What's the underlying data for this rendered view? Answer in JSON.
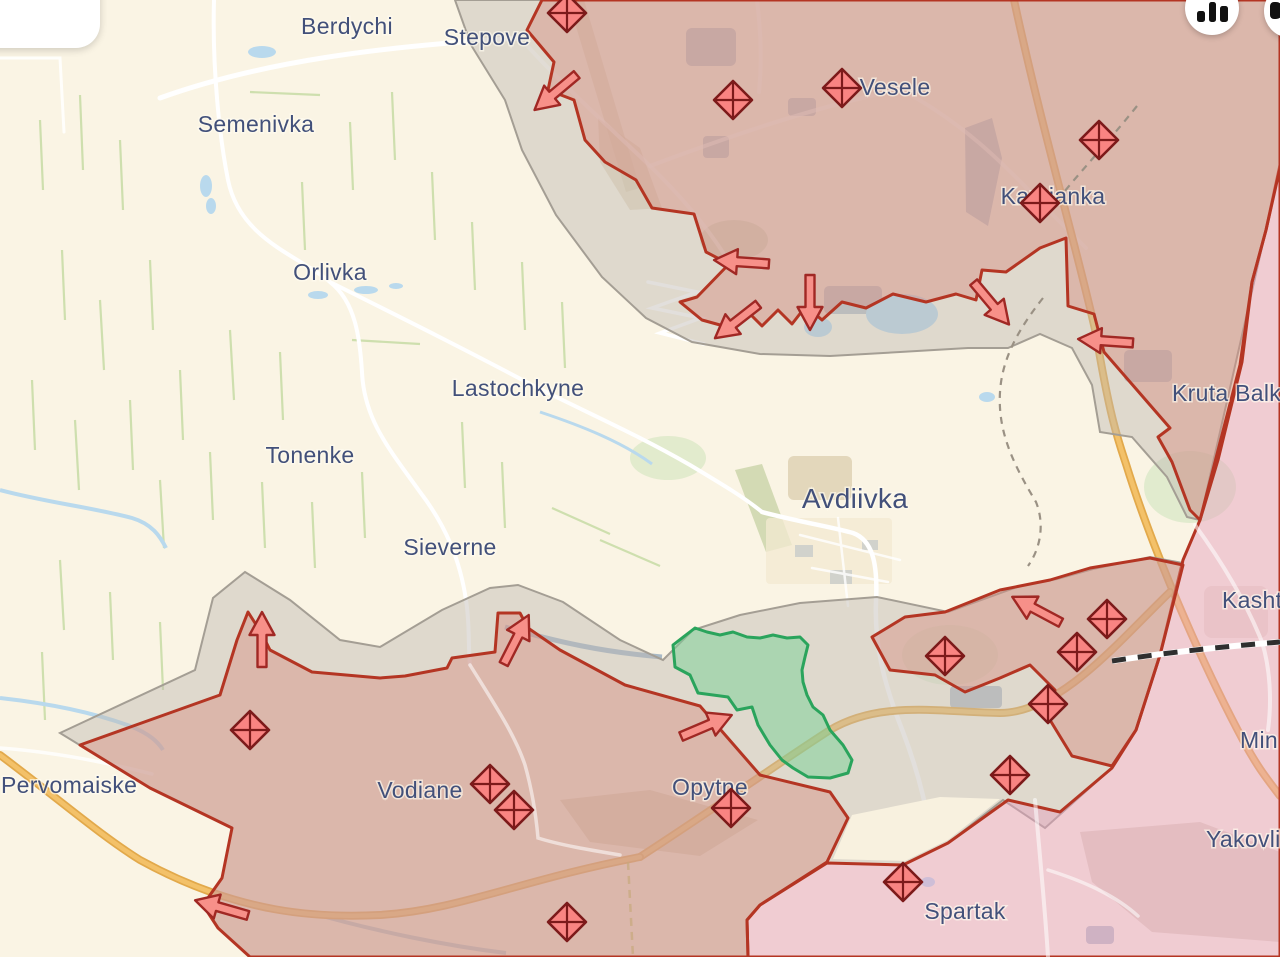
{
  "colors": {
    "bg": "#faf4e4",
    "label": "#42507a",
    "redline": "#b43523",
    "region-2022": "rgba(214,142,131,0.45)",
    "region-2014": "rgba(230,160,190,0.48)",
    "greyzone-fill": "rgba(190,183,178,0.45)",
    "greyzone-line": "#a49e94",
    "green-fill": "rgba(120,210,150,0.5)",
    "green-line": "#2aa45c",
    "unit-fill": "#f98482",
    "unit-line": "#7c1a1a",
    "arrow-fill": "#f79089",
    "arrow-line": "#a02824",
    "water": "#b9d9ed",
    "urban": "#aeb7c2",
    "road": "#ffffff",
    "highway": "#f3c169",
    "highway-edge": "#e2a94b",
    "fieldline": "#c5dba4",
    "railway": "#2f2f2f"
  },
  "map": {
    "labels": [
      {
        "id": "berdychi",
        "text": "Berdychi",
        "x": 347,
        "y": 34,
        "size": 23,
        "anchor": "middle"
      },
      {
        "id": "stepove",
        "text": "Stepove",
        "x": 487,
        "y": 45,
        "size": 23,
        "anchor": "middle"
      },
      {
        "id": "semenivka",
        "text": "Semenivka",
        "x": 256,
        "y": 132,
        "size": 23,
        "anchor": "middle"
      },
      {
        "id": "orlivka",
        "text": "Orlivka",
        "x": 330,
        "y": 280,
        "size": 23,
        "anchor": "middle"
      },
      {
        "id": "lastochkyne",
        "text": "Lastochkyne",
        "x": 518,
        "y": 396,
        "size": 23,
        "anchor": "middle"
      },
      {
        "id": "tonenke",
        "text": "Tonenke",
        "x": 310,
        "y": 463,
        "size": 23,
        "anchor": "middle"
      },
      {
        "id": "sieverne",
        "text": "Sieverne",
        "x": 450,
        "y": 555,
        "size": 23,
        "anchor": "middle"
      },
      {
        "id": "avdiivka",
        "text": "Avdiivka",
        "x": 855,
        "y": 508,
        "size": 28,
        "anchor": "middle"
      },
      {
        "id": "vesele",
        "text": "Vesele",
        "x": 895,
        "y": 95,
        "size": 23,
        "anchor": "middle"
      },
      {
        "id": "kamianka",
        "text": "Kamianka",
        "x": 1053,
        "y": 204,
        "size": 23,
        "anchor": "middle"
      },
      {
        "id": "kruta-balka",
        "text": "Kruta Balk",
        "x": 1172,
        "y": 401,
        "size": 23,
        "anchor": "start"
      },
      {
        "id": "kasht",
        "text": "Kasht",
        "x": 1222,
        "y": 608,
        "size": 23,
        "anchor": "start"
      },
      {
        "id": "min",
        "text": "Min",
        "x": 1240,
        "y": 748,
        "size": 23,
        "anchor": "start"
      },
      {
        "id": "yakovli",
        "text": "Yakovli",
        "x": 1206,
        "y": 847,
        "size": 23,
        "anchor": "start"
      },
      {
        "id": "pervomaiske",
        "text": "Pervomaiske",
        "x": 1,
        "y": 793,
        "size": 23,
        "anchor": "start"
      },
      {
        "id": "vodiane",
        "text": "Vodiane",
        "x": 420,
        "y": 798,
        "size": 23,
        "anchor": "middle"
      },
      {
        "id": "opytne",
        "text": "Opytne",
        "x": 710,
        "y": 795,
        "size": 23,
        "anchor": "middle"
      },
      {
        "id": "spartak",
        "text": "Spartak",
        "x": 965,
        "y": 919,
        "size": 23,
        "anchor": "middle"
      }
    ],
    "units": {
      "icon": "division-diamond-icon",
      "positions": [
        [
          567,
          13
        ],
        [
          733,
          100
        ],
        [
          842,
          88
        ],
        [
          1099,
          140
        ],
        [
          1040,
          203
        ],
        [
          250,
          730
        ],
        [
          490,
          784
        ],
        [
          514,
          810
        ],
        [
          567,
          922
        ],
        [
          731,
          808
        ],
        [
          903,
          882
        ],
        [
          945,
          656
        ],
        [
          1077,
          652
        ],
        [
          1107,
          619
        ],
        [
          1048,
          704
        ],
        [
          1010,
          775
        ]
      ]
    },
    "arrows": {
      "icon": "attack-arrow-icon",
      "items": [
        [
          556,
          92,
          140
        ],
        [
          742,
          262,
          184
        ],
        [
          737,
          321,
          142
        ],
        [
          810,
          302,
          90
        ],
        [
          991,
          303,
          50
        ],
        [
          1106,
          341,
          184
        ],
        [
          1037,
          610,
          208
        ],
        [
          262,
          640,
          270
        ],
        [
          516,
          640,
          297
        ],
        [
          222,
          908,
          196
        ],
        [
          706,
          726,
          337
        ]
      ]
    }
  },
  "controls": {
    "card": {
      "name": "top-left-card"
    },
    "buttons": [
      {
        "name": "stats-button",
        "icon": "bar-chart-icon",
        "left": 1185,
        "top": -19
      },
      {
        "name": "edge-button",
        "icon": "partial-glyph-icon",
        "left": 1264,
        "top": -16
      }
    ]
  }
}
